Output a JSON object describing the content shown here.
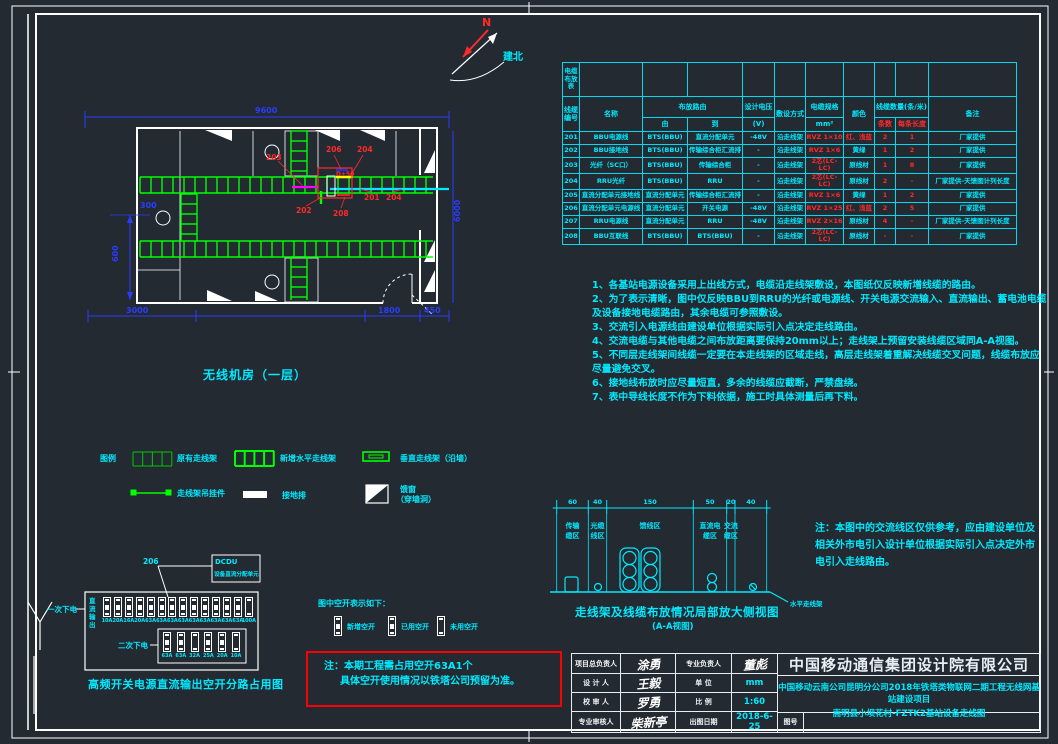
{
  "palette": {
    "background": "#232a32",
    "cyan": "#00eaff",
    "green": "#00ff00",
    "red": "#ff2a2a",
    "blue": "#2b3cff",
    "white": "#ffffff",
    "magenta": "#ff00ff",
    "yellow": "#ffff00"
  },
  "compass": {
    "n": "N",
    "label": "建北"
  },
  "floor_plan": {
    "title": "无线机房（一层）",
    "box_label": "D+50",
    "dim_top": "9600",
    "dim_left_a": "300",
    "dim_left_b": "600",
    "dim_bottom_a": "3000",
    "dim_bottom_b": "1800",
    "dim_bottom_c": "450",
    "dim_right": "6000",
    "callouts": {
      "c203": "203",
      "c206": "206",
      "c204a": "204",
      "c201": "201",
      "c204b": "204",
      "c202": "202",
      "c208": "208"
    }
  },
  "cable_table": {
    "corner": "电缆布放表",
    "headers": {
      "no": "线缆编号",
      "name": "名称",
      "route": "布放路由",
      "from": "由",
      "to": "到",
      "volt": "设计电压",
      "volt_unit": "(V)",
      "method": "敷设方式",
      "spec": "电缆规格",
      "spec_unit": "mm²",
      "color": "颜色",
      "qty": "线缆数量(条/米)",
      "count": "条数",
      "len": "每条长度",
      "remark": "备注"
    },
    "rows": [
      {
        "no": "201",
        "name": "BBU电源线",
        "from": "BTS(BBU)",
        "to": "直流分配单元",
        "volt": "-48V",
        "method": "沿走线架",
        "spec": "RVZ 1×10",
        "color": "红、浅蓝",
        "color_red": true,
        "count": "2",
        "len": "1",
        "remark": "厂家提供"
      },
      {
        "no": "202",
        "name": "BBU接地线",
        "from": "BTS(BBU)",
        "to": "传输综合柜汇流排",
        "volt": "-",
        "method": "沿走线架",
        "spec": "RVZ 1×6",
        "color": "黄绿",
        "color_red": false,
        "count": "1",
        "len": "2",
        "remark": "厂家提供"
      },
      {
        "no": "203",
        "name": "光纤（SC口）",
        "from": "BTS(BBU)",
        "to": "传输综合柜",
        "volt": "-",
        "method": "沿走线架",
        "spec": "2芯(LC-LC)",
        "color": "原线材",
        "color_red": false,
        "count": "1",
        "len": "8",
        "remark": "厂家提供"
      },
      {
        "no": "204",
        "name": "RRU光纤",
        "from": "BTS(BBU)",
        "to": "RRU",
        "volt": "-",
        "method": "沿走线架",
        "spec": "2芯(LC-LC)",
        "color": "原线材",
        "color_red": false,
        "count": "2",
        "len": "-",
        "remark": "厂家提供-天馈图计列长度"
      },
      {
        "no": "205",
        "name": "直流分配单元接地线",
        "from": "直流分配单元",
        "to": "传输综合柜汇流排",
        "volt": "-",
        "method": "沿走线架",
        "spec": "RVZ 1×6",
        "color": "黄绿",
        "color_red": false,
        "count": "1",
        "len": "2",
        "remark": "厂家提供"
      },
      {
        "no": "206",
        "name": "直流分配单元电源线",
        "from": "直流分配单元",
        "to": "开关电源",
        "volt": "-48V",
        "method": "沿走线架",
        "spec": "RVZ 1×25",
        "color": "红、浅蓝",
        "color_red": true,
        "count": "2",
        "len": "5",
        "remark": "厂家提供"
      },
      {
        "no": "207",
        "name": "RRU电源线",
        "from": "直流分配单元",
        "to": "RRU",
        "volt": "-48V",
        "method": "沿走线架",
        "spec": "RVZ 2×16",
        "color": "原线材",
        "color_red": false,
        "count": "4",
        "len": "-",
        "remark": "厂家提供-天馈图计列长度"
      },
      {
        "no": "208",
        "name": "BBU互联线",
        "from": "BTS(BBU)",
        "to": "BTS(BBU)",
        "volt": "-",
        "method": "沿走线架",
        "spec": "2芯(LC-LC)",
        "color": "原线材",
        "color_red": false,
        "count": "-",
        "len": "-",
        "remark": "厂家提供"
      }
    ]
  },
  "notes": {
    "lines": [
      "1、各基站电源设备采用上出线方式，电缆沿走线架敷设，本图纸仅反映新增线缆的路由。",
      "2、为了表示清晰，图中仅反映BBU到RRU的光纤或电源线、开关电源交流输入、直流输出、蓄电池电缆及设备接地电缆路由，其余电缆可参照敷设。",
      "3、交流引入电源线由建设单位根据实际引入点决定走线路由。",
      "4、交流电缆与其他电缆之间布放距离要保持20mm以上；走线架上预留安装线缆区域同A-A视图。",
      "5、不同层走线架间线缆一定要在本走线架的区域走线，高层走线架着重解决线缆交叉问题，线缆布放应尽量避免交叉。",
      "6、接地线布放时应尽量短直，多余的线缆应截断，严禁盘绕。",
      "7、表中导线长度不作为下料依据，施工时具体测量后再下料。"
    ]
  },
  "legend": {
    "title": "图例",
    "existing_tray": "原有走线架",
    "new_tray": "新增水平走线架",
    "vertical_tray": "垂直走线架（沿墙）",
    "hanger": "走线架吊挂件",
    "ground_bar": "接地排",
    "feeder_window_1": "馈窗",
    "feeder_window_2": "（穿墙洞）"
  },
  "aa_view": {
    "dims": [
      "60",
      "40",
      "150",
      "50",
      "20",
      "40"
    ],
    "zones": [
      [
        "传输",
        "缆区"
      ],
      [
        "光缆",
        "线区"
      ],
      [
        "馈线区"
      ],
      [
        "直流电",
        "缆区"
      ],
      [
        "交流",
        "缆区"
      ]
    ],
    "tray_label": "水平走线架",
    "title": "走线架及线缆布放情况局部放大侧视图",
    "subtitle": "(A-A视图)"
  },
  "side_note": "注：本图中的交流线区仅供参考，应由建设单位及相关外市电引入设计单位根据实际引入点决定外市电引入走线路由。",
  "breaker_panel": {
    "title": "高频开关电源直流输出空开分路占用图",
    "callout_no": "206",
    "callout_line1": "DCDU",
    "callout_line2": "设备直流分配单元",
    "label_primary": "一次下电",
    "label_secondary": "二次下电",
    "vertical_label": "直流输出",
    "row1": {
      "states": [
        "used",
        "used",
        "used",
        "used",
        "used",
        "new",
        "used",
        "used",
        "used",
        "used",
        "used",
        "used",
        "used",
        "unused"
      ],
      "labels": [
        "10A",
        "20A",
        "16A",
        "20A",
        "63A",
        "63A",
        "63A",
        "63A",
        "63A",
        "63A",
        "63A",
        "63A",
        "63A",
        "100A"
      ]
    },
    "row2": {
      "states": [
        "used",
        "used",
        "unused",
        "used",
        "used",
        "unused"
      ],
      "labels": [
        "63A",
        "63A",
        "32A",
        "25A",
        "20A",
        "10A"
      ]
    }
  },
  "breaker_legend": {
    "title": "图中空开表示如下：",
    "items": [
      {
        "state": "new",
        "label": "新增空开"
      },
      {
        "state": "used",
        "label": "已用空开"
      },
      {
        "state": "unused",
        "label": "未用空开"
      }
    ]
  },
  "red_note": {
    "line1": "注：本期工程需占用空开63A1个",
    "line2": "具体空开使用情况以铁塔公司预留为准。"
  },
  "title_block": {
    "company": "中国移动通信集团设计院有限公司",
    "project_line1": "中国移动云南公司昆明分公司2018年铁塔类物联网二期工程无线网基站建设项目",
    "project_line2": "嵩明县小坝花村-FZTK2基站设备走线图",
    "fig_no_label": "图号",
    "rows": [
      {
        "label1": "项目总负责人",
        "sig": "涂勇",
        "label2": "专业负责人",
        "val": "董彪",
        "val_is_sig": true
      },
      {
        "label1": "设 计 人",
        "sig": "王毅",
        "label2": "单  位",
        "val": "mm",
        "val_is_sig": false
      },
      {
        "label1": "校 审 人",
        "sig": "罗勇",
        "label2": "比  例",
        "val": "1:60",
        "val_is_sig": false
      },
      {
        "label1": "专业审核人",
        "sig": "柴新亭",
        "label2": "出图日期",
        "val": "2018-6-25",
        "val_is_sig": false
      }
    ]
  }
}
